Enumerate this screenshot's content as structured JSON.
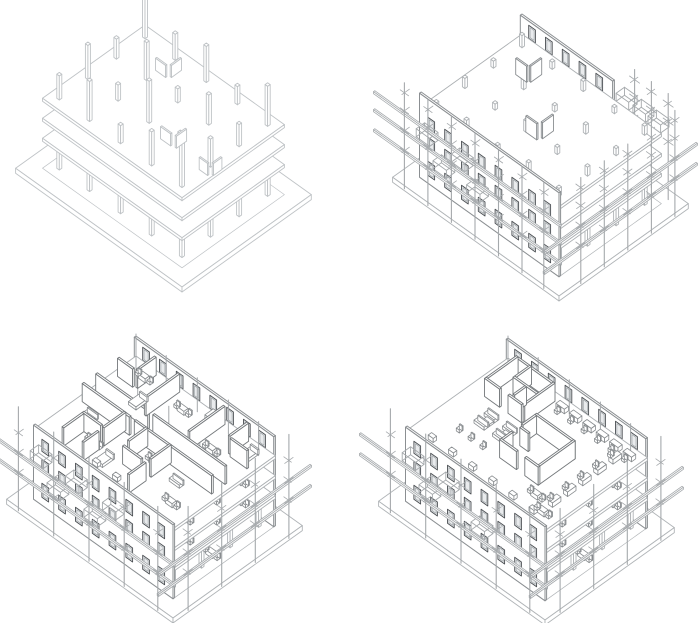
{
  "canvas": {
    "width": 700,
    "height": 623,
    "background": "#ffffff"
  },
  "colors": {
    "background": "#ffffff",
    "structure_light": "#bfc3c6",
    "structure": "#b0b4b7",
    "slab": "#acb0b3",
    "wall": "#8b8f92",
    "wall_dark": "#4b4f53",
    "mid": "#9aa0a3",
    "partition": "#74787b",
    "furniture": "#888c8f",
    "scaffold": "#a5a9ac",
    "glass": "#e9ebed"
  },
  "iso": {
    "ux": 0.84,
    "uy": 0.6
  },
  "building": {
    "W": 166,
    "D": 122,
    "slab_levels": [
      30,
      50,
      70
    ],
    "slab_thickness": 3,
    "base_margin": 16,
    "base_thickness": 5,
    "columns_u": [
      10,
      46,
      83,
      120,
      156
    ],
    "columns_v": [
      10,
      44,
      78,
      112
    ],
    "column_size": 3,
    "facade_thickness": 2,
    "partition_height": 18,
    "partition_thickness": 2,
    "window": {
      "width": 8,
      "rows": [
        8,
        34,
        54
      ],
      "row_heights": [
        14,
        12,
        12
      ],
      "positions": [
        10,
        30,
        50,
        70,
        90,
        110,
        130,
        148
      ]
    },
    "backwall_window_bottom": 73,
    "backwall_window_height": 13
  },
  "panels": [
    {
      "name": "structural-frame",
      "origin": [
        145,
        95
      ],
      "palette": "light",
      "base": true,
      "columns": true,
      "slabs": true,
      "column_stubs": [
        44,
        26,
        36,
        18,
        40,
        20,
        38,
        14,
        30,
        22,
        34,
        16,
        42,
        12,
        28,
        24,
        40,
        18,
        34,
        45
      ],
      "stub_walls": [
        [
          "u",
          44,
          30,
          12,
          70
        ],
        [
          "v",
          58,
          16,
          12,
          70
        ],
        [
          "u",
          104,
          84,
          12,
          70
        ],
        [
          "v",
          120,
          72,
          12,
          70
        ],
        [
          "u",
          136,
          70,
          10,
          50
        ],
        [
          "v",
          148,
          58,
          10,
          50
        ]
      ]
    },
    {
      "name": "envelope-construction",
      "origin": [
        172,
        104
      ],
      "base": true,
      "columns": true,
      "slabs": true,
      "column_stubs": [
        12,
        7,
        10,
        6,
        9,
        7,
        11,
        6,
        9,
        7,
        10,
        6,
        11,
        7,
        9,
        6,
        10,
        7,
        12,
        8
      ],
      "back_wall": {
        "u0": 0,
        "u1": 110,
        "top": 90,
        "windows": [
          10,
          30,
          50,
          70,
          90
        ]
      },
      "facade": {
        "top": 84
      },
      "deck_panels": [
        [
          "u",
          30,
          36,
          13
        ],
        [
          "v",
          44,
          22,
          13
        ],
        [
          "u",
          84,
          78,
          13
        ],
        [
          "v",
          98,
          62,
          13
        ]
      ],
      "balconies": [
        [
          6,
          2
        ],
        [
          26,
          1
        ],
        [
          48,
          2
        ],
        [
          66,
          1
        ]
      ],
      "back_boxes": [
        112,
        132,
        150
      ],
      "scaffold": {
        "left_poles": [
          -6,
          22,
          50,
          78,
          106,
          134,
          160
        ],
        "right_poles": [
          -4,
          24,
          52,
          80,
          108
        ],
        "back_poles": [
          120,
          140,
          160
        ],
        "tick_levels": [
          30,
          50,
          70,
          88
        ],
        "left_rails": [
          28,
          48,
          66
        ],
        "right_rails": [
          28,
          48
        ],
        "pole_top": 98
      }
    },
    {
      "name": "interior-partitions",
      "origin": [
        136,
        114
      ],
      "base": true,
      "columns": true,
      "slabs": true,
      "back_wall": {
        "u0": 0,
        "u1": 166,
        "top": 90,
        "windows": [
          10,
          30,
          50,
          70,
          90,
          110,
          130,
          148
        ]
      },
      "facade": {
        "top": 74
      },
      "partitions": [
        [
          "u",
          6,
          52,
          62
        ],
        [
          "u",
          74,
          52,
          86
        ],
        [
          "u",
          6,
          68,
          56
        ],
        [
          "u",
          68,
          68,
          92
        ],
        [
          "v",
          54,
          4,
          40
        ],
        [
          "v",
          54,
          68,
          26
        ],
        [
          "v",
          54,
          100,
          18
        ],
        [
          "v",
          108,
          4,
          42
        ],
        [
          "v",
          108,
          68,
          24
        ],
        [
          "v",
          108,
          98,
          20
        ],
        [
          "v",
          26,
          4,
          22
        ],
        [
          "u",
          6,
          26,
          18
        ],
        [
          "v",
          136,
          4,
          22
        ],
        [
          "u",
          140,
          26,
          20
        ],
        [
          "v",
          80,
          68,
          22
        ],
        [
          "u",
          82,
          96,
          22
        ],
        [
          "u",
          30,
          92,
          22
        ],
        [
          "v",
          30,
          94,
          24
        ]
      ],
      "deck_furniture": [
        [
          "table2",
          20,
          12
        ],
        [
          "bed",
          36,
          32
        ],
        [
          "table2",
          70,
          16
        ],
        [
          "wardrobe",
          100,
          8
        ],
        [
          "table2",
          120,
          32
        ],
        [
          "bed",
          146,
          10
        ],
        [
          "sofa",
          18,
          76
        ],
        [
          "table2",
          44,
          96
        ],
        [
          "bed",
          64,
          100
        ],
        [
          "table2",
          96,
          76
        ],
        [
          "sofa",
          124,
          80
        ],
        [
          "table2",
          140,
          100
        ],
        [
          "box",
          64,
          112
        ],
        [
          "box",
          88,
          112
        ]
      ],
      "floor_furniture": {
        "levels": [
          30,
          50
        ],
        "items": [
          [
            "table2",
            146,
            24
          ],
          [
            "chair",
            152,
            56
          ],
          [
            "table2",
            144,
            88
          ]
        ],
        "ground": [
          [
            "table2",
            148,
            60
          ]
        ]
      },
      "balconies": [
        [
          6,
          2
        ],
        [
          26,
          1
        ],
        [
          48,
          2
        ],
        [
          70,
          1
        ],
        [
          92,
          2
        ]
      ],
      "roof_poles": {
        "v10": [
          10,
          46,
          83,
          120,
          156
        ],
        "v44": [
          46,
          83,
          120
        ]
      },
      "scaffold": {
        "left_poles": [
          -6,
          36,
          78,
          120,
          160
        ],
        "right_poles": [
          -4,
          36,
          76,
          116
        ],
        "tick_levels": [
          30,
          50,
          70
        ],
        "left_rails": [
          28,
          48
        ],
        "right_rails": [
          28,
          48
        ],
        "pole_top": 96
      }
    },
    {
      "name": "fit-out-furnished",
      "origin": [
        158,
        116
      ],
      "base": true,
      "columns": true,
      "slabs": true,
      "back_wall": {
        "u0": 0,
        "u1": 166,
        "top": 90,
        "windows": [
          10,
          30,
          50,
          70,
          90,
          110,
          130,
          148
        ]
      },
      "facade": {
        "top": 74
      },
      "partitions": [
        [
          "u",
          78,
          44,
          46
        ],
        [
          "v",
          122,
          44,
          44
        ],
        [
          "u",
          78,
          86,
          20
        ],
        [
          "u",
          108,
          86,
          16
        ],
        [
          "v",
          78,
          46,
          16
        ],
        [
          "v",
          78,
          74,
          12
        ],
        [
          "u",
          80,
          64,
          10
        ],
        [
          "u",
          18,
          8,
          44
        ],
        [
          "v",
          18,
          8,
          36
        ],
        [
          "v",
          62,
          8,
          36
        ],
        [
          "u",
          18,
          44,
          18
        ],
        [
          "u",
          46,
          44,
          16
        ],
        [
          "v",
          34,
          8,
          18
        ],
        [
          "u",
          34,
          26,
          28
        ],
        [
          "v",
          48,
          28,
          14
        ]
      ],
      "desk_rows": {
        "back": {
          "v": 8,
          "u": [
            70,
            86,
            102,
            118,
            134,
            150
          ]
        },
        "right": {
          "u": 146,
          "v": [
            16,
            34,
            52,
            70,
            88
          ]
        }
      },
      "deck_furniture": [
        [
          "sofa",
          34,
          58
        ],
        [
          "sofa",
          34,
          70
        ],
        [
          "ltable",
          38,
          63
        ],
        [
          "sofa",
          56,
          58
        ],
        [
          "sofa",
          56,
          70
        ],
        [
          "ltable",
          60,
          63
        ],
        [
          "chair",
          30,
          88
        ],
        [
          "chair",
          44,
          88
        ],
        [
          "chair",
          58,
          88
        ],
        [
          "table2",
          128,
          96
        ],
        [
          "table2",
          146,
          106
        ]
      ],
      "edge_boxes": [
        20,
        44,
        68,
        92,
        116,
        140
      ],
      "floor_furniture": {
        "levels": [
          30,
          50
        ],
        "items": [
          [
            "table2",
            146,
            24
          ],
          [
            "chair",
            152,
            56
          ],
          [
            "table2",
            144,
            88
          ]
        ],
        "ground": [
          [
            "table2",
            148,
            60
          ]
        ]
      },
      "balconies": [
        [
          6,
          2
        ],
        [
          26,
          1
        ],
        [
          48,
          2
        ],
        [
          88,
          1
        ]
      ],
      "roof_poles": {
        "v10": [
          10,
          46,
          83,
          120,
          156
        ],
        "v44": []
      },
      "scaffold": {
        "left_poles": [
          -6,
          36,
          78,
          120,
          160
        ],
        "right_poles": [
          -4,
          36,
          76,
          116
        ],
        "tick_levels": [
          30,
          50,
          70
        ],
        "left_rails": [
          28,
          48
        ],
        "right_rails": [
          28,
          48
        ],
        "pole_top": 96
      }
    }
  ]
}
